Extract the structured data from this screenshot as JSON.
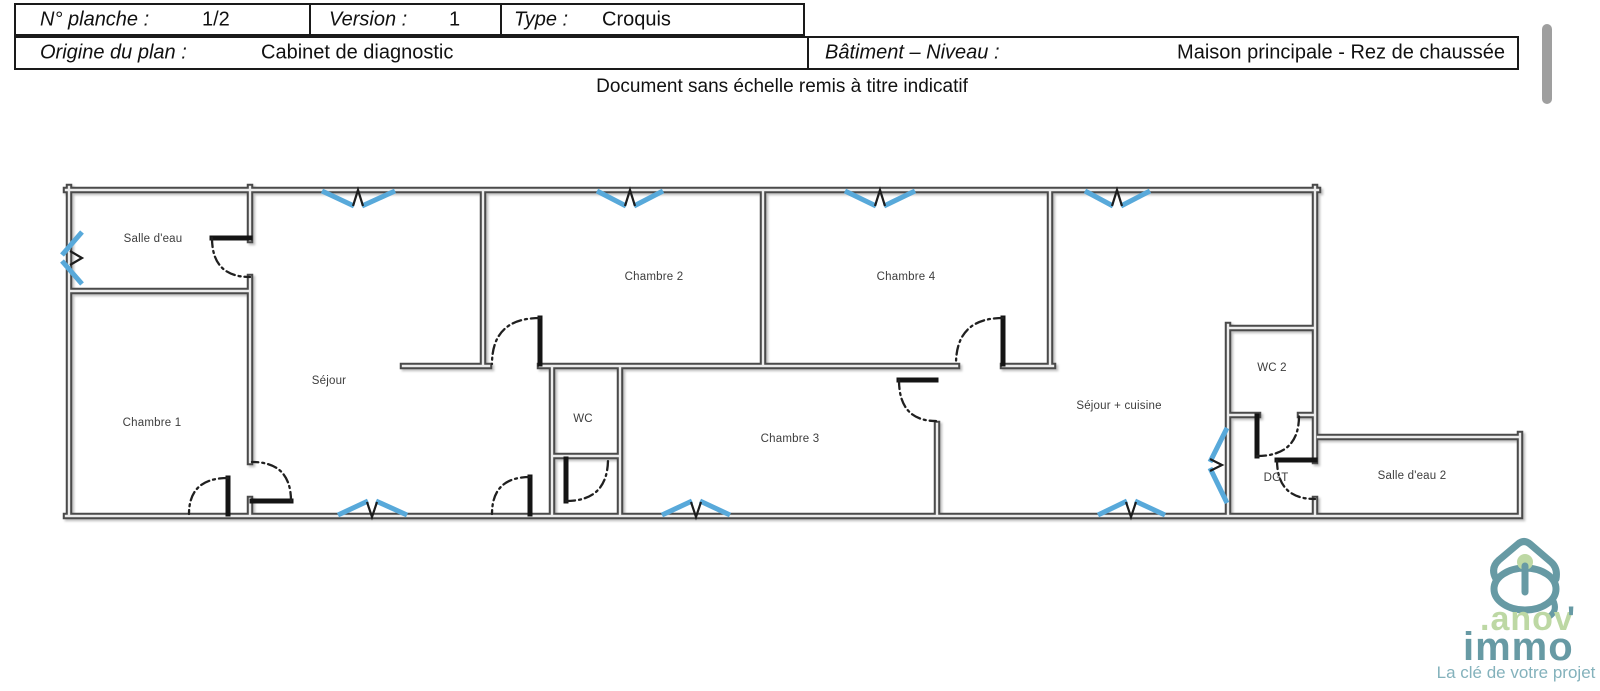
{
  "header": {
    "row1": [
      {
        "label": "N° planche :",
        "value": "1/2"
      },
      {
        "label": "Version :",
        "value": "1"
      },
      {
        "label": "Type :",
        "value": "Croquis"
      }
    ],
    "row2": [
      {
        "label": "Origine du plan :",
        "value": "Cabinet de diagnostic"
      },
      {
        "label": "Bâtiment – Niveau :",
        "value": "Maison principale - Rez de chaussée"
      }
    ],
    "caption": "Document sans échelle remis à titre indicatif"
  },
  "plan": {
    "colors": {
      "wall": "#4a4a4a",
      "window_blue": "#58a9da",
      "door_black": "#141414"
    },
    "rooms": [
      {
        "name": "salle-deau",
        "label": "Salle d'eau"
      },
      {
        "name": "chambre-1",
        "label": "Chambre 1"
      },
      {
        "name": "sejour",
        "label": "Séjour"
      },
      {
        "name": "chambre-2",
        "label": "Chambre 2"
      },
      {
        "name": "wc",
        "label": "WC"
      },
      {
        "name": "chambre-3",
        "label": "Chambre 3"
      },
      {
        "name": "chambre-4",
        "label": "Chambre 4"
      },
      {
        "name": "sejour-cuisine",
        "label": "Séjour + cuisine"
      },
      {
        "name": "wc-2",
        "label": "WC 2"
      },
      {
        "name": "dgt",
        "label": "DGT"
      },
      {
        "name": "salle-deau-2",
        "label": "Salle d'eau 2"
      }
    ]
  },
  "logo": {
    "mark": ".anov",
    "apostrophe": "'",
    "word": "immo",
    "tagline": "La clé de votre projet",
    "teal": "#679aa4",
    "green": "#bdd8a4",
    "tagline_color": "#84b2bc"
  }
}
